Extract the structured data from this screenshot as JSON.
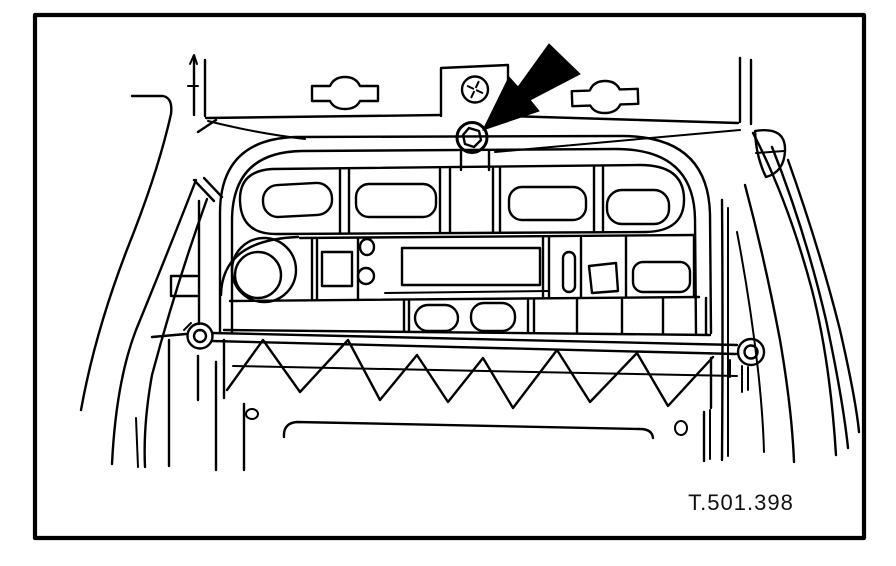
{
  "figure": {
    "reference_code": "T.501.398"
  },
  "colors": {
    "line": "#000000",
    "background": "#ffffff"
  }
}
